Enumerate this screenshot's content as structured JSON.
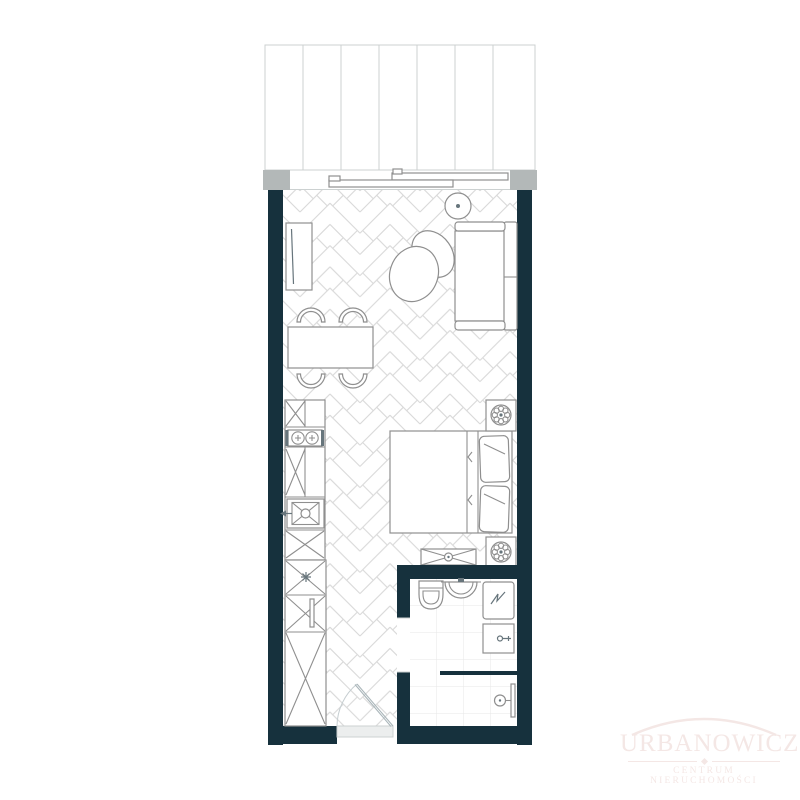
{
  "watermark": {
    "title": "URBANOWICZ",
    "subtitle": "CENTRUM NIERUCHOMOŚCI"
  },
  "palette": {
    "wall": "#16313d",
    "balcony_block": "#b3b8b8",
    "balcony_line": "#ccd1d1",
    "floor_line": "#d9d9d9",
    "tile_line": "#e7e7e7",
    "furniture_line": "#8f8f8f",
    "detail_line": "#67757c",
    "logo": "#f4e7e5"
  },
  "floorplan": {
    "rooms": [
      {
        "name": "balcony"
      },
      {
        "name": "living-room-with-kitchenette"
      },
      {
        "name": "bathroom"
      },
      {
        "name": "entrance-hall"
      }
    ],
    "elements": [
      "balcony-decking",
      "sliding-balcony-door",
      "herringbone-parquet-floor",
      "tv-sideboard",
      "round-side-table",
      "sofa",
      "armchair",
      "dining-table",
      "dining-chairs",
      "kitchen-counter",
      "two-burner-cooktop",
      "kitchen-sink",
      "tall-cabinet-column",
      "double-bed",
      "pillows",
      "nightstand-with-plant",
      "storage-bench",
      "bathroom-tile-floor",
      "toilet",
      "washbasin",
      "washing-machine",
      "bathroom-cabinet",
      "walk-in-shower",
      "entrance-door-swing"
    ]
  }
}
